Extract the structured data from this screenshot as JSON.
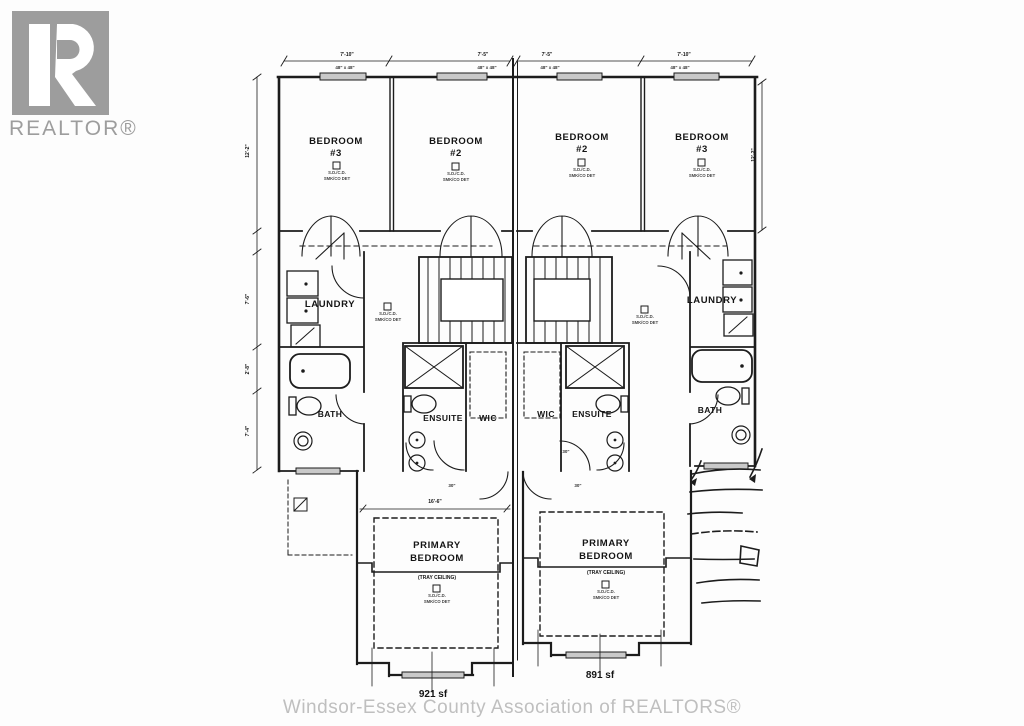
{
  "logo": {
    "brand": "REALTOR®"
  },
  "footer": {
    "credit": "Windsor-Essex County Association of REALTORS®"
  },
  "plan": {
    "dims": {
      "top": [
        "7'-10\"",
        "7'-5\"",
        "7'-5\"",
        "7'-10\""
      ],
      "windows": [
        "48\" x 48\"",
        "48\" x 48\"",
        "48\" x 48\"",
        "48\" x 48\""
      ],
      "left_side": [
        "12'-2\"",
        "7'-6\"",
        "2'-8\"",
        "7'-4\""
      ],
      "right_side": "12'-2\"",
      "primary_width": "16'-6\"",
      "door": "30\""
    },
    "left_unit": {
      "bedroom3": {
        "title": "BEDROOM",
        "num": "#3"
      },
      "bedroom2": {
        "title": "BEDROOM",
        "num": "#2"
      },
      "laundry": "LAUNDRY",
      "bath": "BATH",
      "ensuite": "ENSUITE",
      "wic": "WIC",
      "primary": {
        "l1": "PRIMARY",
        "l2": "BEDROOM",
        "note": "(TRAY CEILING)"
      },
      "area": "921 sf"
    },
    "right_unit": {
      "bedroom2": {
        "title": "BEDROOM",
        "num": "#2"
      },
      "bedroom3": {
        "title": "BEDROOM",
        "num": "#3"
      },
      "laundry": "LAUNDRY",
      "bath": "BATH",
      "ensuite": "ENSUITE",
      "wic": "WIC",
      "primary": {
        "l1": "PRIMARY",
        "l2": "BEDROOM",
        "note": "(TRAY CEILING)"
      },
      "area": "891 sf"
    },
    "detector": {
      "l1": "S.D./C.D.",
      "l2": "SMK/CO DET"
    }
  },
  "colors": {
    "line": "#1c1c1c",
    "logo_gray": "#9d9d9d",
    "footer_gray": "#bfbfbf",
    "window_fill": "#c9c9c9"
  }
}
